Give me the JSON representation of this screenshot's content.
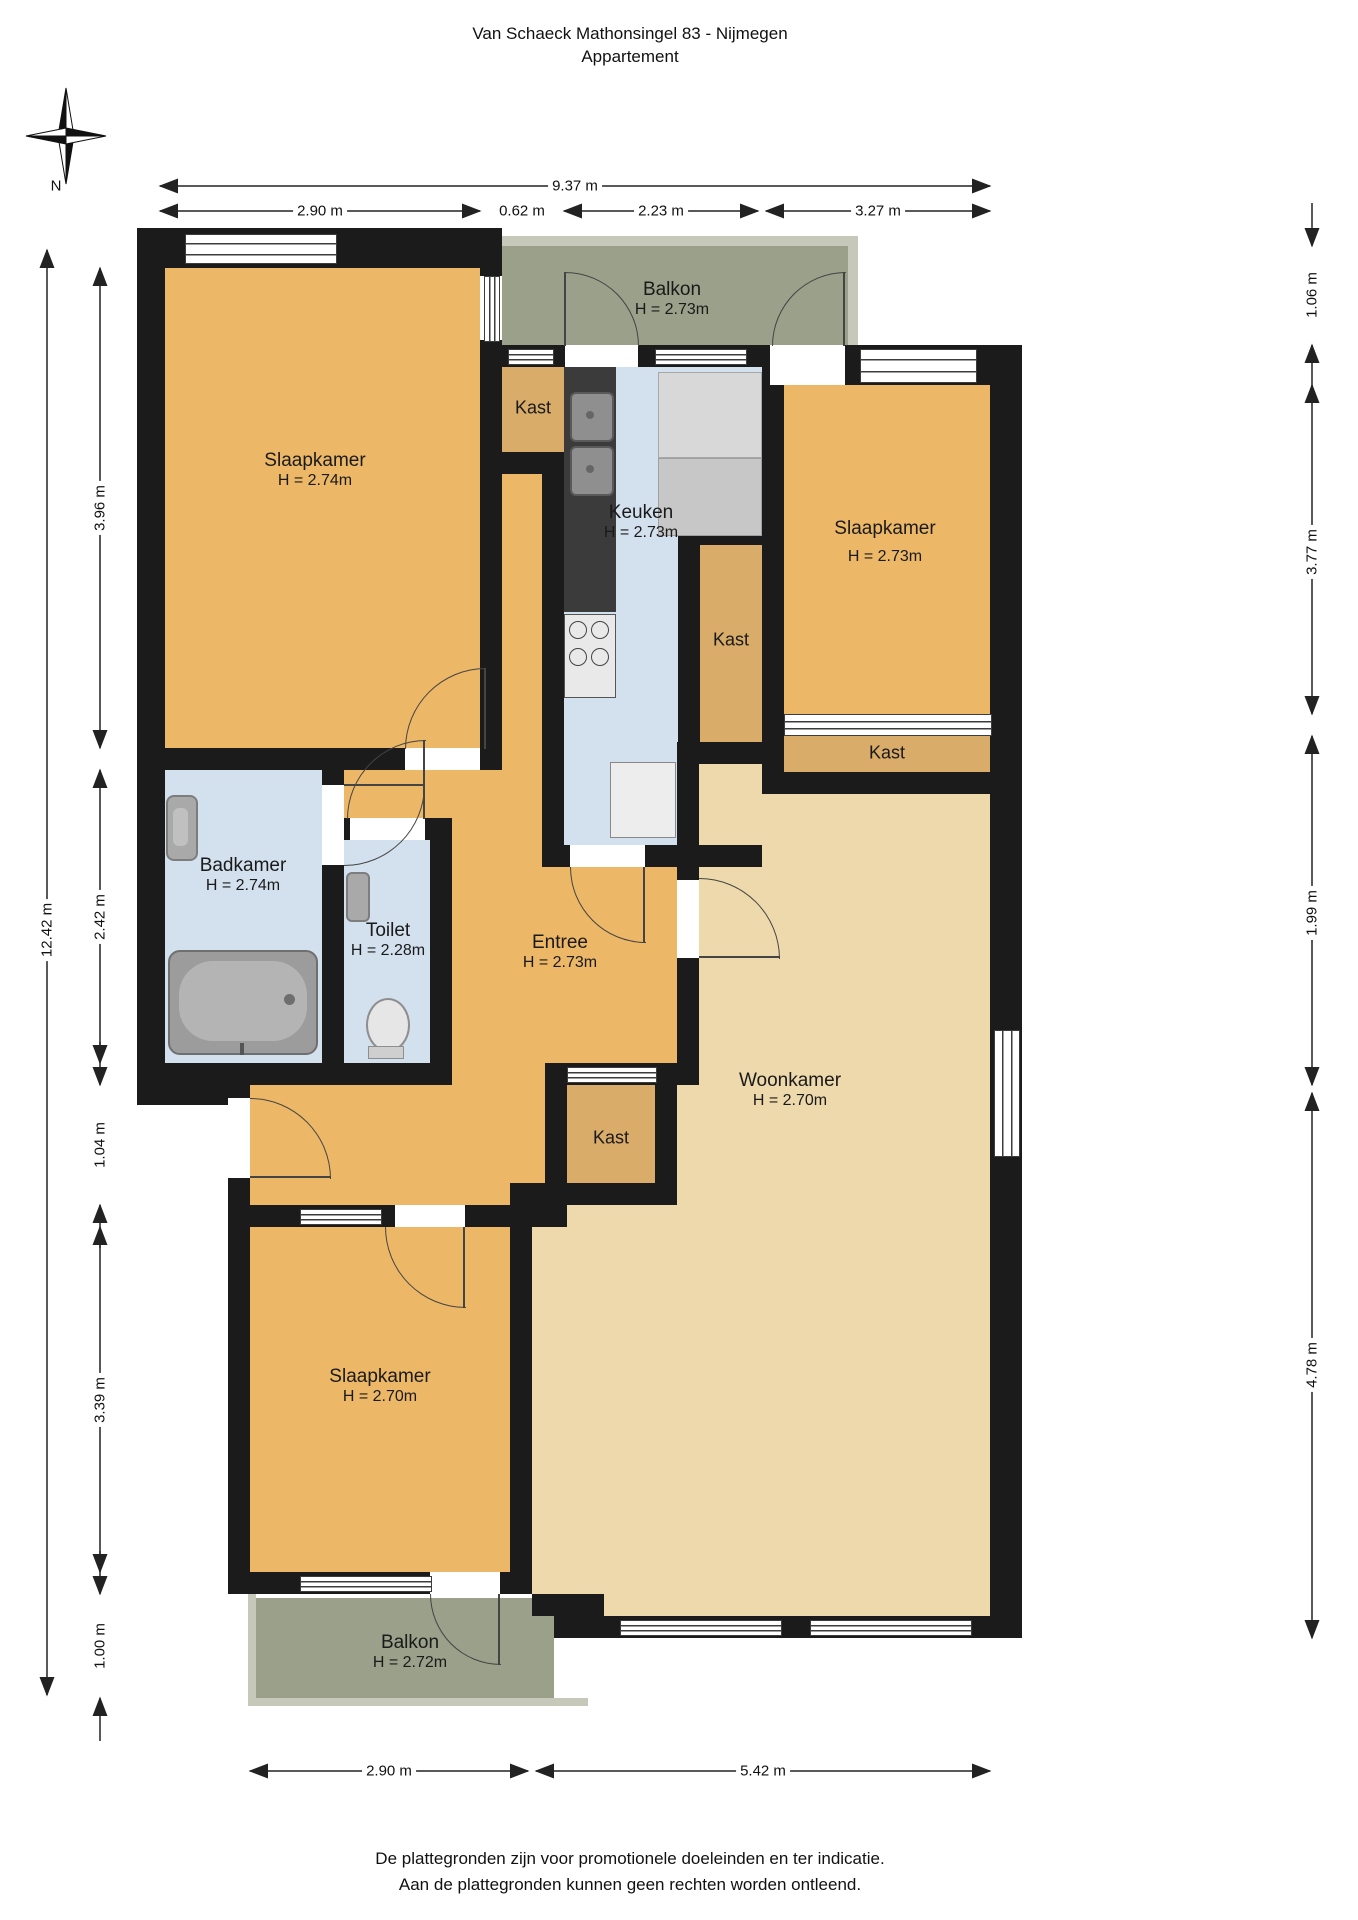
{
  "title": {
    "line1": "Van Schaeck Mathonsingel 83 - Nijmegen",
    "line2": "Appartement"
  },
  "compass": {
    "north_label": "N"
  },
  "rooms": {
    "slaapkamer_tl": {
      "name": "Slaapkamer",
      "height": "H = 2.74m"
    },
    "balkon_top": {
      "name": "Balkon",
      "height": "H = 2.73m"
    },
    "kast_top": {
      "name": "Kast"
    },
    "keuken": {
      "name": "Keuken",
      "height": "H = 2.73m"
    },
    "slaapkamer_rechts": {
      "name": "Slaapkamer",
      "height": "H = 2.73m"
    },
    "kast_keuken": {
      "name": "Kast"
    },
    "kast_rechts": {
      "name": "Kast"
    },
    "badkamer": {
      "name": "Badkamer",
      "height": "H = 2.74m"
    },
    "toilet": {
      "name": "Toilet",
      "height": "H = 2.28m"
    },
    "entree": {
      "name": "Entree",
      "height": "H = 2.73m"
    },
    "kast_midden": {
      "name": "Kast"
    },
    "slaapkamer_beneden": {
      "name": "Slaapkamer",
      "height": "H = 2.70m"
    },
    "woonkamer": {
      "name": "Woonkamer",
      "height": "H = 2.70m"
    },
    "balkon_beneden": {
      "name": "Balkon",
      "height": "H = 2.72m"
    }
  },
  "dimensions": {
    "top_total": "9.37 m",
    "top_segments": [
      "2.90 m",
      "0.62 m",
      "2.23 m",
      "3.27 m"
    ],
    "left_total": "12.42 m",
    "left_segments": [
      "3.96 m",
      "2.42 m",
      "1.04 m",
      "3.39 m",
      "1.00 m"
    ],
    "right_segments": [
      "1.06 m",
      "3.77 m",
      "1.99 m",
      "4.78 m"
    ],
    "bottom_segments": [
      "2.90 m",
      "5.42 m"
    ]
  },
  "footer": {
    "line1": "De plattegronden zijn voor promotionele doeleinden en ter indicatie.",
    "line2": "Aan de plattegronden kunnen geen rechten worden ontleend."
  },
  "colors": {
    "wall": "#1b1b1b",
    "room_orange": "#ecb766",
    "kast_tan": "#d9ac69",
    "woonkamer_tan": "#edd9ab",
    "wet_room_blue": "#d3e0ee",
    "balkon_green": "#9aa089",
    "railing_grey": "#c6c8ba"
  }
}
